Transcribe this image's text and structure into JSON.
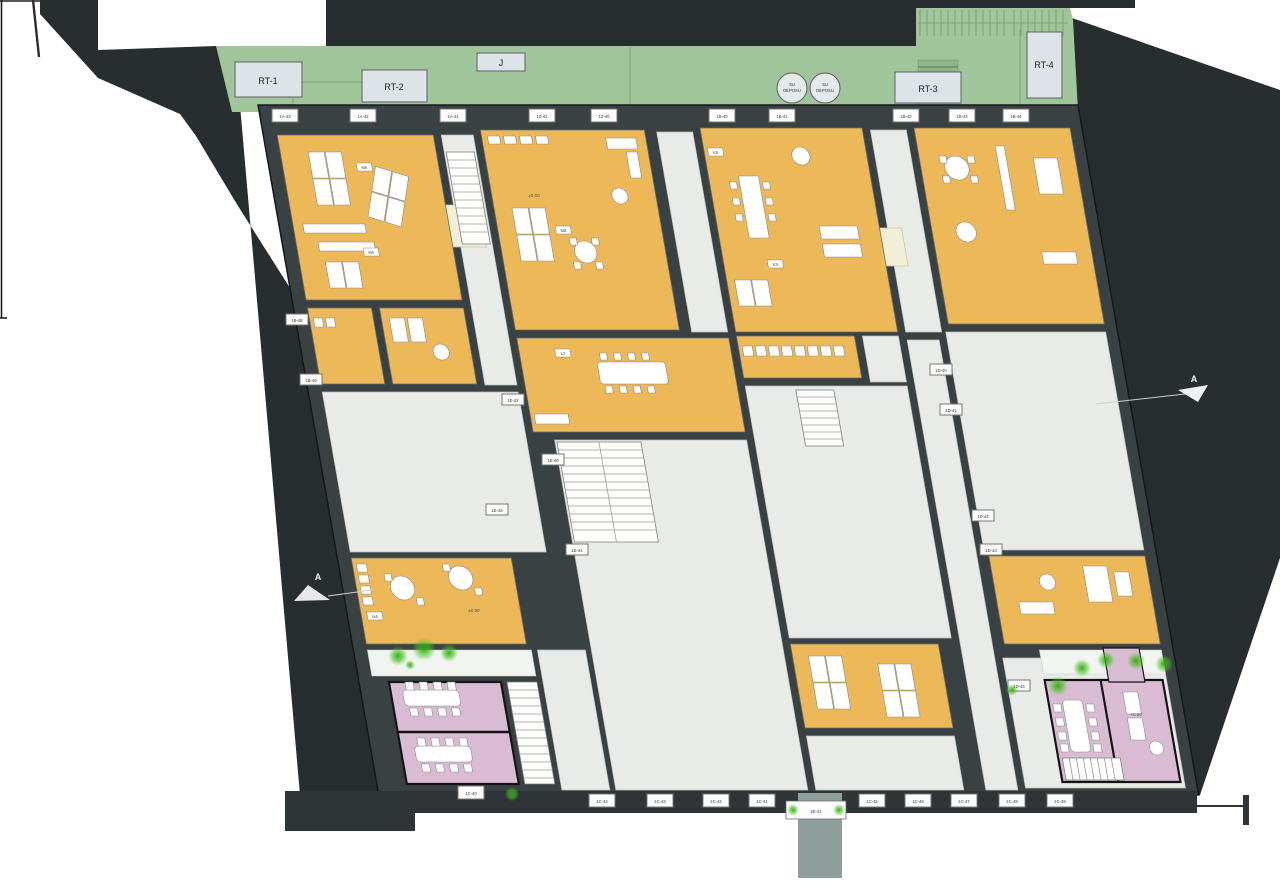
{
  "drawing": {
    "type": "architectural-floor-plan",
    "palette": {
      "site_dark": "#282e30",
      "wall_dark": "#3a4143",
      "roof_green": "#a0c59b",
      "room_orange": "#ecb858",
      "court_gray": "#e9ebe8",
      "meeting_pink": "#d9bcd4",
      "skylight_cream": "#f3eed7",
      "vestibule_sage": "#8d9e9b",
      "tree_green": "#3db01c",
      "label_box": "#dde3e6"
    }
  },
  "roof": {
    "rt1": "RT-1",
    "rt2": "RT-2",
    "j": "J",
    "rt3": "RT-3",
    "rt4": "RT-4",
    "tank_line1": "SU",
    "tank_line2": "DEPOSU"
  },
  "section_markers": {
    "left": "A",
    "right": "A"
  },
  "entry_tag": "2E-41",
  "tags": {
    "top": [
      "1A-43",
      "1A-42",
      "1A-41",
      "1Z-41",
      "1Z-40",
      "1B-40",
      "1B-41",
      "1B-42",
      "1B-43",
      "1B-44"
    ],
    "bottom": [
      "1C-40",
      "1C-44",
      "1C-43",
      "1C-42",
      "1C-41",
      "1C-45",
      "1C-46",
      "1C-47",
      "1C-48",
      "1C-49"
    ],
    "interior": [
      "1B-48",
      "1B-49",
      "1E-42",
      "1E-40",
      "1E-43",
      "1E-41",
      "1D-40",
      "1D-41",
      "1D-42",
      "1D-43",
      "1D-44"
    ]
  },
  "room_chips": [
    "M6",
    "M5",
    "M8",
    "K8",
    "K3",
    "L2",
    "N4"
  ],
  "elevations": {
    "e1": "±0.00",
    "e2": "±0.00",
    "e3": "+0.50"
  }
}
